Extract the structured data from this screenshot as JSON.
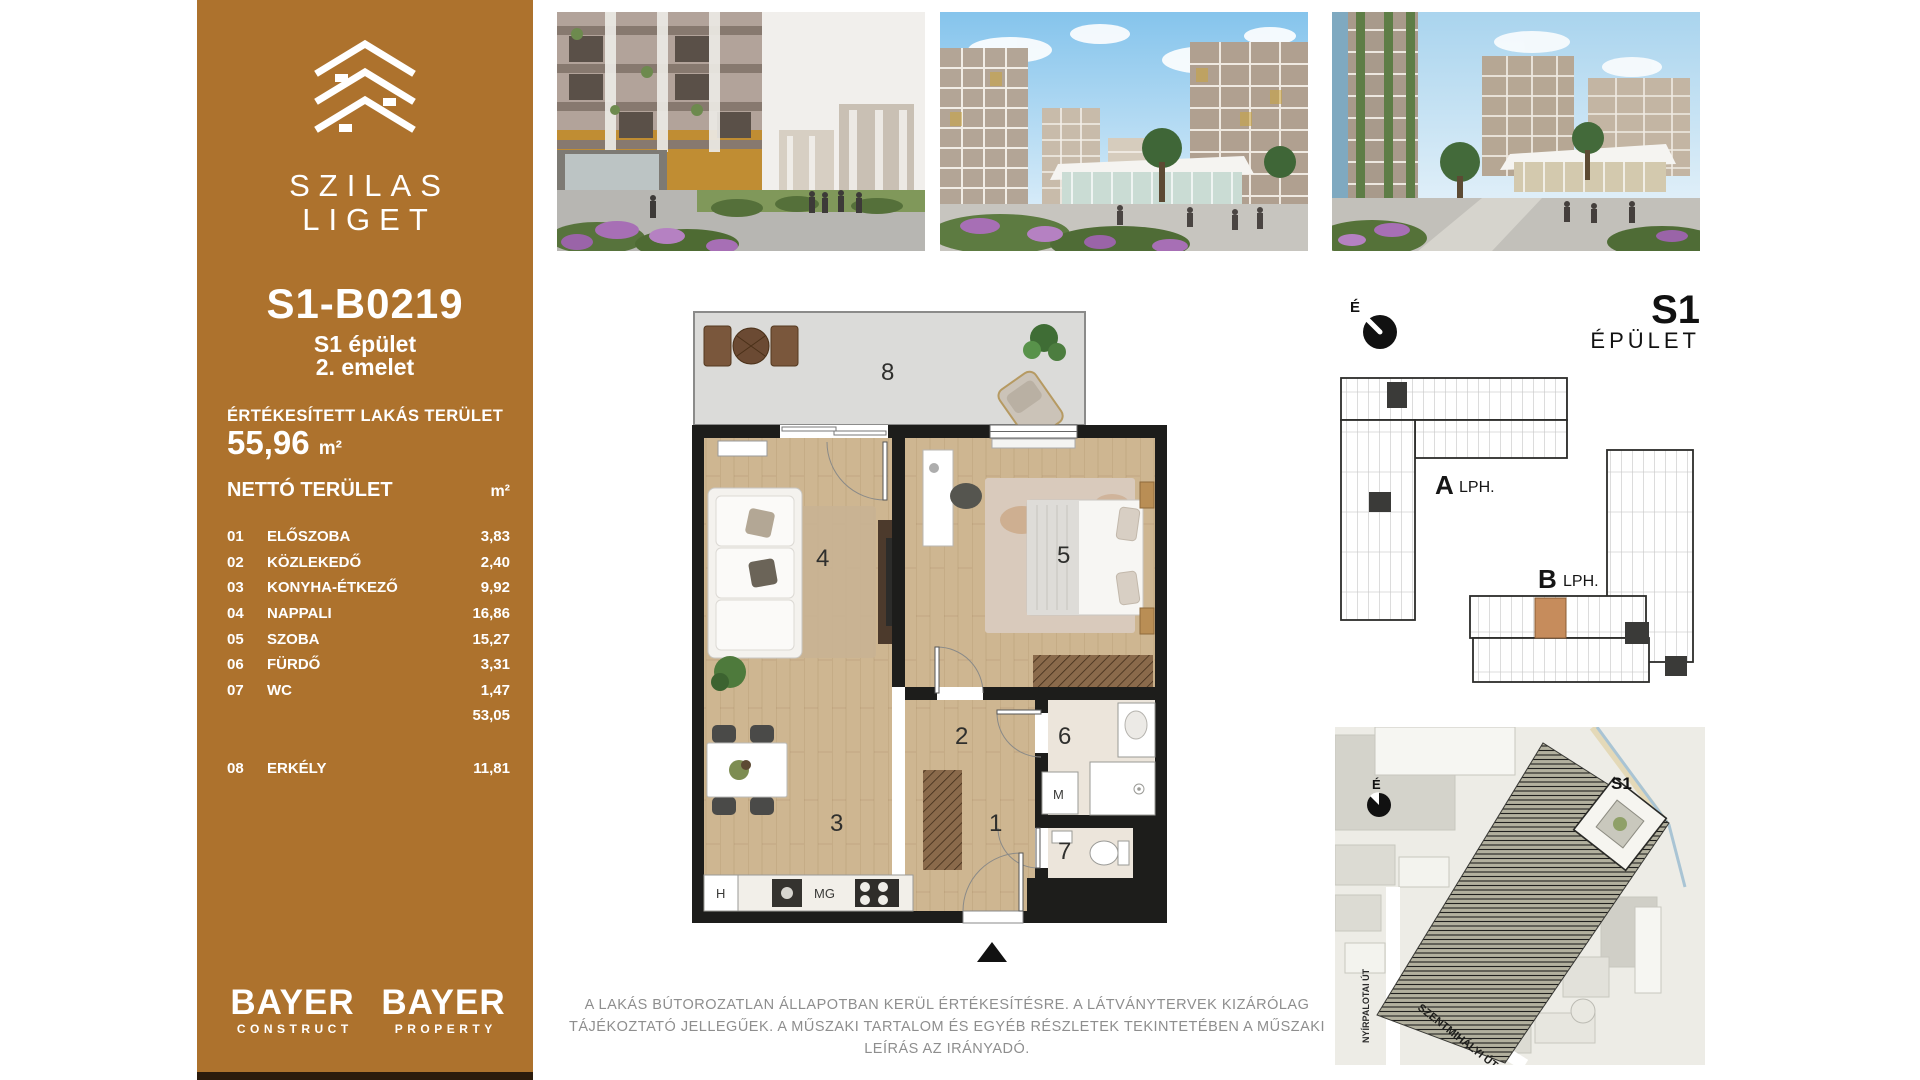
{
  "sidebar": {
    "brand": {
      "line1": "SZILAS",
      "line2": "LIGET"
    },
    "unit_code": "S1-B0219",
    "building": "S1 épület",
    "floor": "2. emelet",
    "sold_area_label": "ÉRTÉKESÍTETT LAKÁS TERÜLET",
    "sold_area_value": "55,96",
    "sold_area_unit": "m²",
    "net_area_label": "NETTÓ TERÜLET",
    "net_area_unit": "m²",
    "rooms": [
      {
        "num": "01",
        "name": "ELŐSZOBA",
        "area": "3,83"
      },
      {
        "num": "02",
        "name": "KÖZLEKEDŐ",
        "area": "2,40"
      },
      {
        "num": "03",
        "name": "KONYHA-ÉTKEZŐ",
        "area": "9,92"
      },
      {
        "num": "04",
        "name": "NAPPALI",
        "area": "16,86"
      },
      {
        "num": "05",
        "name": "SZOBA",
        "area": "15,27"
      },
      {
        "num": "06",
        "name": "FÜRDŐ",
        "area": "3,31"
      },
      {
        "num": "07",
        "name": "WC",
        "area": "1,47"
      }
    ],
    "subtotal": "53,05",
    "balcony_row": {
      "num": "08",
      "name": "ERKÉLY",
      "area": "11,81"
    },
    "logos": [
      {
        "name": "BAYER",
        "sub": "CONSTRUCT"
      },
      {
        "name": "BAYER",
        "sub": "PROPERTY"
      }
    ]
  },
  "floor_plan": {
    "rooms": {
      "r1": "1",
      "r2": "2",
      "r3": "3",
      "r4": "4",
      "r5": "5",
      "r6": "6",
      "r7": "7",
      "r8": "8"
    },
    "labels": {
      "fridge": "H",
      "stove": "MG",
      "washing_machine": "M"
    }
  },
  "building_plan": {
    "compass": "É",
    "building_big": "S1",
    "building_small": "ÉPÜLET",
    "stairwell_a": "A",
    "lph_a": "LPH.",
    "stairwell_b": "B",
    "lph_b": "LPH."
  },
  "site_map": {
    "compass": "É",
    "building_marker": "S1",
    "street_vertical": "NYÍRPALOTAI ÚT",
    "street_diagonal": "SZENTMIHÁLYI ÚT"
  },
  "disclaimer": {
    "text": "A LAKÁS BÚTOROZATLAN ÁLLAPOTBAN KERÜL ÉRTÉKESÍTÉSRE. A LÁTVÁNYTERVEK KIZÁRÓLAG TÁJÉKOZTATÓ JELLEGŰEK. A MŰSZAKI TARTALOM ÉS EGYÉB RÉSZLETEK TEKINTETÉBEN A MŰSZAKI LEÍRÁS AZ IRÁNYADÓ."
  },
  "colors": {
    "sidebar_brown": "#AD722D",
    "highlight_orange": "#C68C5C",
    "wall_black": "#1D1D1B"
  }
}
